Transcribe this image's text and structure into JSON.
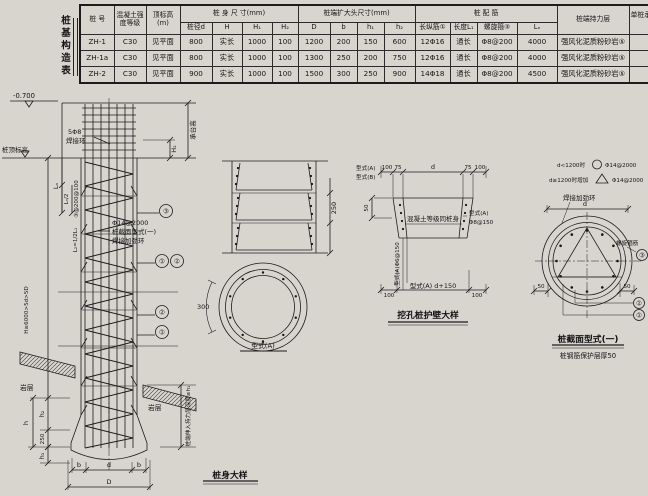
{
  "table": {
    "side_title": "桩基构造表",
    "header": {
      "pile_no": "桩 号",
      "concrete": "混凝土强度等级",
      "top_elev": "顶标高(m)",
      "body_dims": "桩 身 尺 寸(mm)",
      "body_sub": [
        "桩径d",
        "H",
        "H₁",
        "H₂"
      ],
      "head_dims": "桩端扩大头尺寸(mm)",
      "head_sub": [
        "D",
        "b",
        "h₁",
        "h₂"
      ],
      "rebar": "桩 配 筋",
      "rebar_sub": [
        "长纵筋①",
        "长度L₁",
        "螺旋箍③",
        "Lₙ"
      ],
      "bearing": "桩端持力层",
      "capacity": "单桩承载力特征值(kN)"
    },
    "rows": [
      [
        "ZH-1",
        "C30",
        "见平面",
        "800",
        "实长",
        "1000",
        "100",
        "1200",
        "200",
        "150",
        "600",
        "12Φ16",
        "通长",
        "Φ8@200",
        "4000",
        "强风化泥质粉砂岩⑤",
        "1800"
      ],
      [
        "ZH-1a",
        "C30",
        "见平面",
        "800",
        "实长",
        "1000",
        "100",
        "1300",
        "250",
        "200",
        "750",
        "12Φ16",
        "通长",
        "Φ8@200",
        "4000",
        "强风化泥质粉砂岩⑤",
        "2100"
      ],
      [
        "ZH-2",
        "C30",
        "见平面",
        "900",
        "实长",
        "1000",
        "100",
        "1500",
        "300",
        "250",
        "900",
        "14Φ18",
        "通长",
        "Φ8@200",
        "4500",
        "强风化泥质粉砂岩⑤",
        "2820"
      ]
    ]
  },
  "pile": {
    "elev": "-0.700",
    "top_elev_label": "桩顶标高",
    "weld1": "5Φ8",
    "weld2": "焊接环",
    "cap_h": "承台高",
    "h2": "H₂",
    "ln": "Lₙ",
    "ln_half": "Lₙ/2",
    "sp": "③@200@100",
    "l2": "L₂=1/2L₁",
    "H": "H≥6000>5d>5D",
    "c1": "①",
    "c2": "②",
    "c3": "③",
    "note1": "Φ14@2000",
    "note2": "桩截面型式(一)",
    "note3": "焊接加劲环",
    "rock": "岩层",
    "embed": "桩端伸入持力层深度≥h₁",
    "h": "h",
    "h2b": "h₂",
    "d250": "250",
    "h1": "h₁",
    "b": "b",
    "d": "d",
    "D": "D",
    "title": "桩身大样"
  },
  "wall_stack": {
    "dim250": "250",
    "arc300": "300",
    "type_a": "型式(A)"
  },
  "wall_detail": {
    "d100": "100",
    "d75": "75",
    "dd": "d",
    "d50": "50",
    "type_a": "型式(A)",
    "type_b": "型式(B)",
    "note": "混凝土等级同桩身",
    "right_a": "型式(A)",
    "right_bar": "Φ8@150",
    "vert": "型式(A)Φ6@150",
    "bottom_mid": "型式(A)  d+150",
    "title": "挖孔桩护壁大样"
  },
  "section": {
    "leg1": "d<1200时",
    "leg1b": "Φ14@2000",
    "leg2": "d≥1200时增加",
    "leg2b": "Φ14@2000",
    "stiff": "焊接加劲环",
    "dd": "d",
    "spiral": "螺旋箍筋",
    "c1": "①",
    "c2": "②",
    "c3": "③",
    "d50": "50",
    "title": "桩截面型式(一)",
    "subtitle": "桩钢筋保护层厚50"
  }
}
